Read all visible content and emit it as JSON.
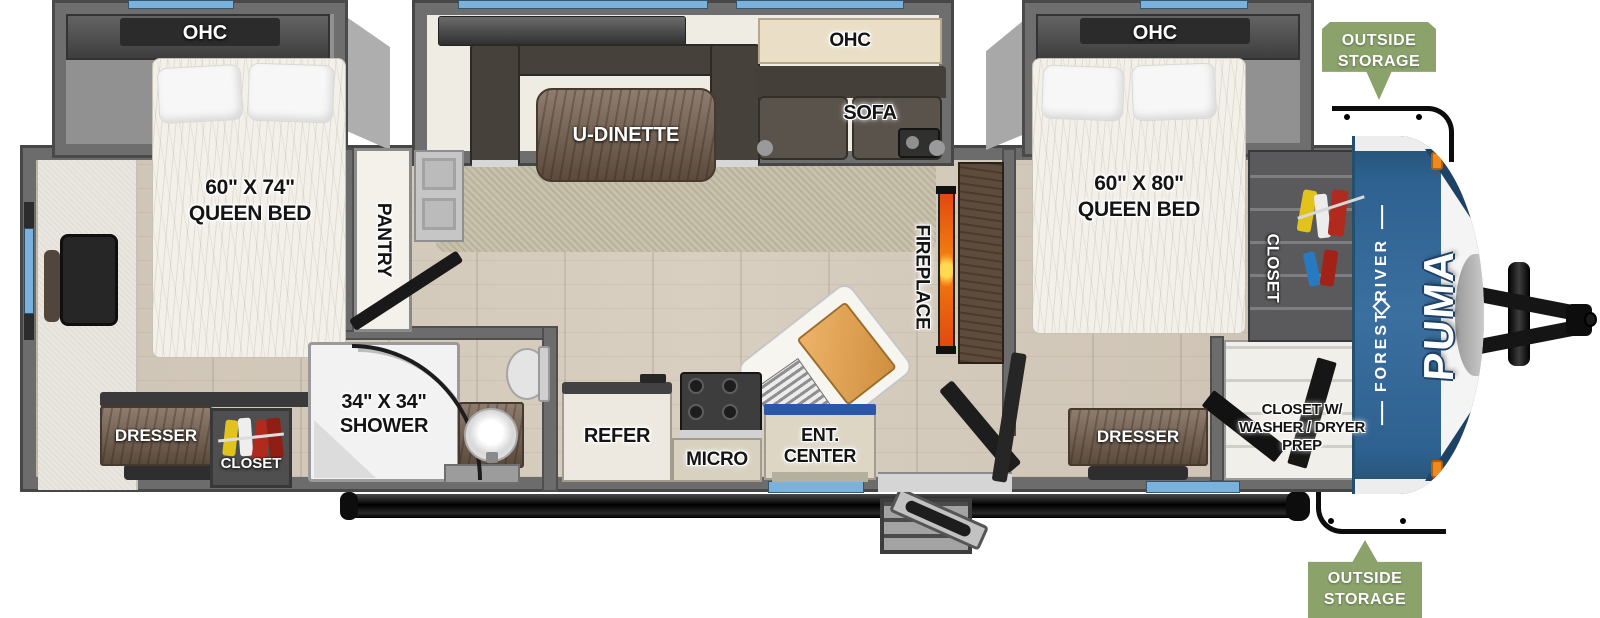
{
  "labels": {
    "rear_bedroom_ohc": "OHC",
    "rear_bed_size": "60\" X 74\"",
    "rear_bed_type": "QUEEN BED",
    "pantry": "PANTRY",
    "dinette": "U-DINETTE",
    "living_ohc": "OHC",
    "sofa": "SOFA",
    "fireplace": "FIREPLACE",
    "front_bedroom_ohc": "OHC",
    "front_bed_size": "60\" X 80\"",
    "front_bed_type": "QUEEN BED",
    "front_closet": "CLOSET",
    "rear_dresser": "DRESSER",
    "rear_closet": "CLOSET",
    "shower_size": "34\" X 34\"",
    "shower": "SHOWER",
    "refer": "REFER",
    "micro": "MICRO",
    "ent_center": "ENT. CENTER",
    "front_dresser": "DRESSER",
    "wd_closet_line1": "CLOSET W/",
    "wd_closet_line2": "WASHER / DRYER",
    "wd_closet_line3": "PREP",
    "storage_top_line1": "OUTSIDE",
    "storage_top_line2": "STORAGE",
    "storage_bottom_line1": "OUTSIDE",
    "storage_bottom_line2": "STORAGE",
    "brand_manufacturer": "FOREST RIVER",
    "brand_model": "PUMA"
  },
  "colors": {
    "window_accent": "#79b2dd",
    "storage_tag_green": "#8ba26b",
    "front_cap_blue": "#336691",
    "fireplace_flame_orange": "#f2820f",
    "wall_gray": "#6c6c6c"
  }
}
